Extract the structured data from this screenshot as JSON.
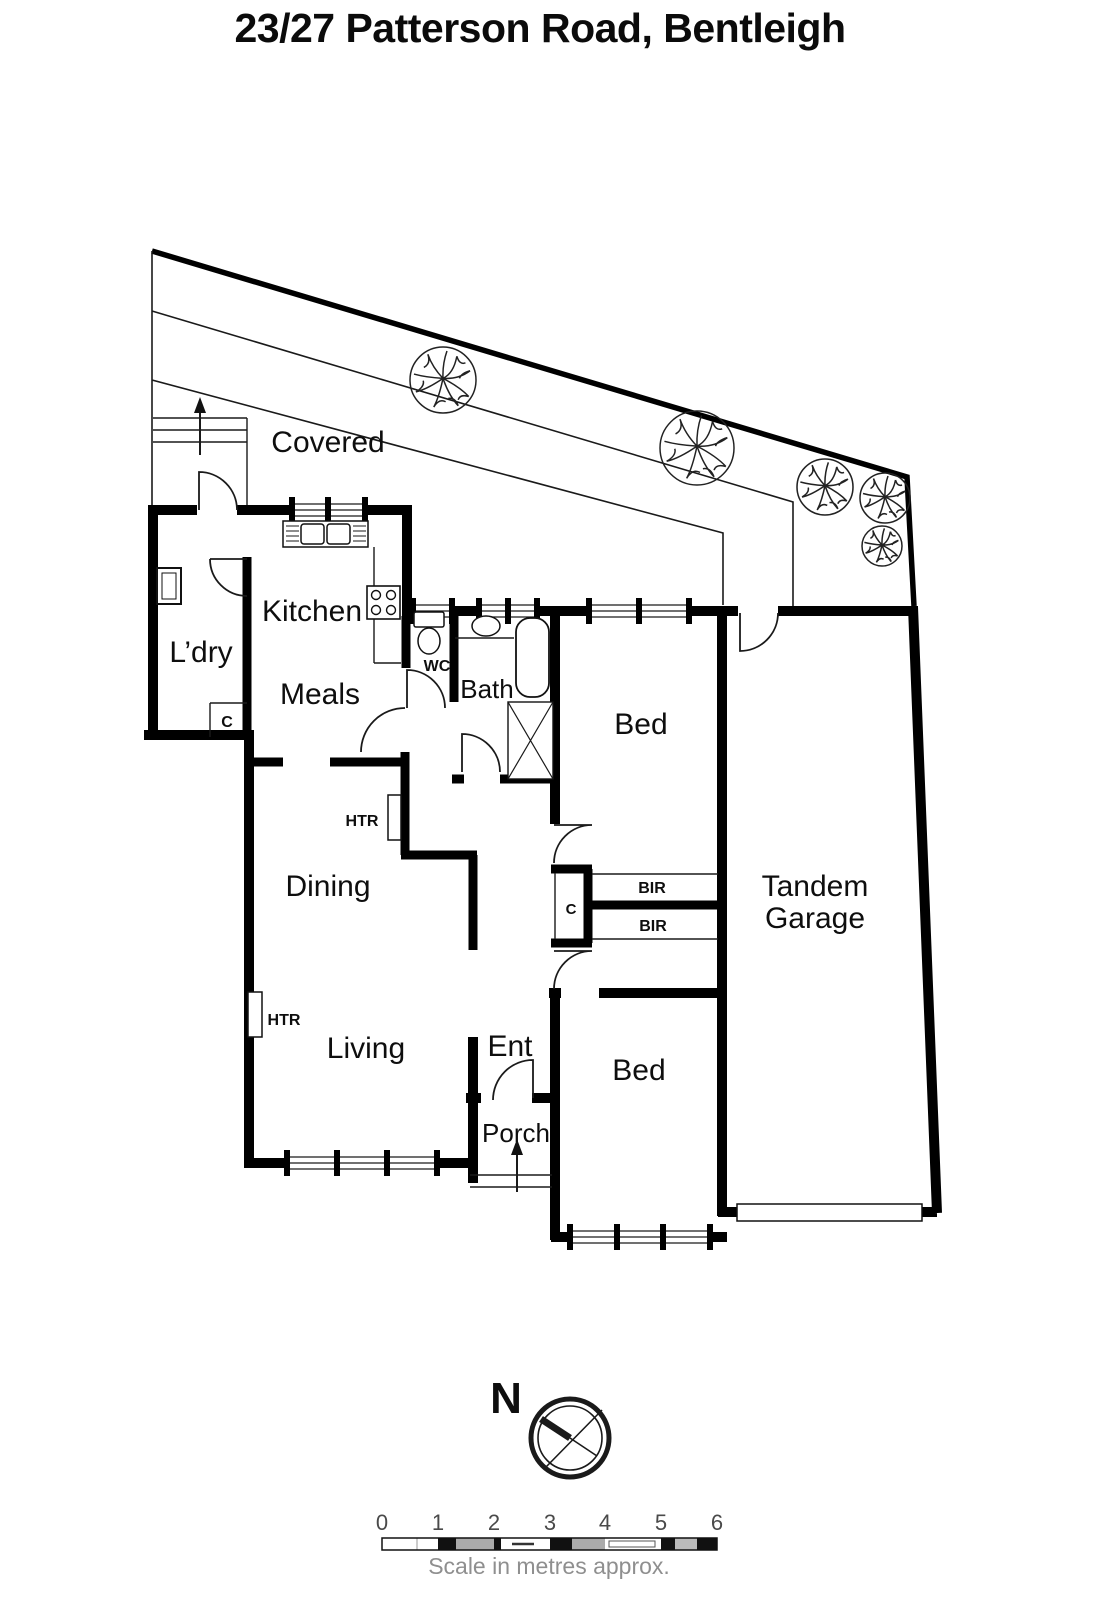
{
  "title": "23/27 Patterson Road, Bentleigh",
  "rooms": {
    "covered": "Covered",
    "laundry": "L’dry",
    "kitchen": "Kitchen",
    "meals": "Meals",
    "wc": "WC",
    "bath": "Bath",
    "bed": "Bed",
    "dining": "Dining",
    "living": "Living",
    "entry": "Ent",
    "porch": "Porch",
    "garage_line1": "Tandem",
    "garage_line2": "Garage",
    "heater": "HTR",
    "closet": "C",
    "robe": "BIR"
  },
  "compass": {
    "north": "N"
  },
  "scale_bar": {
    "ticks": [
      "0",
      "1",
      "2",
      "3",
      "4",
      "5",
      "6"
    ],
    "caption": "Scale in metres approx."
  },
  "colors": {
    "wall": "#000000",
    "label": "#0e0e0e",
    "scale_gray": "#ababab"
  }
}
